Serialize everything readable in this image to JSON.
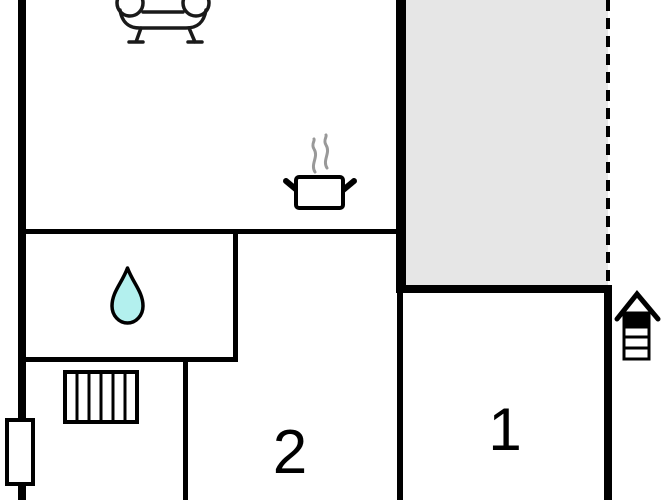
{
  "floorplan": {
    "type": "vacation-home-floor-plan",
    "room_labels": {
      "room1": "1",
      "room2": "2"
    },
    "icons": {
      "sofa": "sofa-icon",
      "cooking_pot": "cooking-pot-icon",
      "steam": "steam-icon",
      "water_drop": "water-drop-icon",
      "stairs": "stairs-icon",
      "window": "window-marker",
      "entrance": "entrance-house-icon"
    },
    "colors": {
      "wall": "#000000",
      "terrace_fill": "#e6e6e6",
      "water_drop_fill": "#b3f0ee",
      "steam": "#999999",
      "icon_stroke": "#1a1a1a",
      "background": "#ffffff"
    }
  }
}
